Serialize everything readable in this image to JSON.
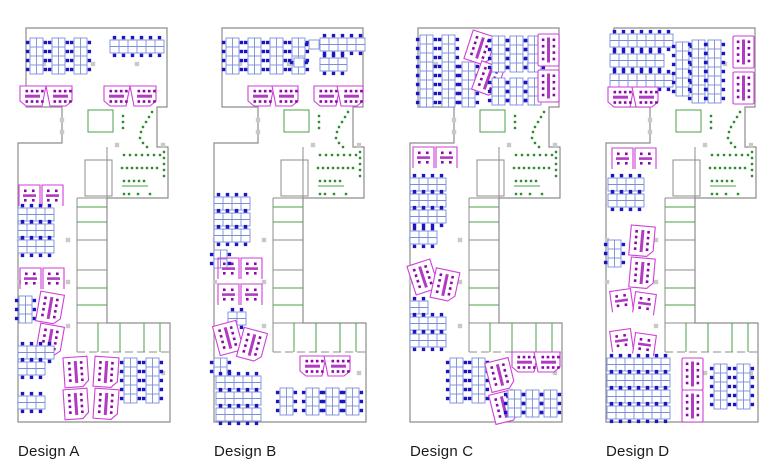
{
  "palette": {
    "wall": "#8d8d8d",
    "column": "#c9c9c9",
    "green": "#4aa04a",
    "greenDot": "#2d8c2d",
    "deskStroke": "#7b8fd9",
    "deskFill": "#ffffff",
    "chair": "#1c16c0",
    "pod": "#cf3fd8",
    "podDot": "#8d07a8",
    "podBar": "#b13cc2",
    "label": "#1a1a1a",
    "background": "#ffffff"
  },
  "architecture": {
    "outline": [
      [
        8,
        28
      ],
      [
        149,
        28
      ],
      [
        149,
        107
      ],
      [
        139,
        107
      ],
      [
        139,
        147
      ],
      [
        150,
        147
      ],
      [
        150,
        198
      ],
      [
        89,
        198
      ],
      [
        89,
        323
      ],
      [
        152,
        323
      ],
      [
        152,
        422
      ],
      [
        0,
        422
      ],
      [
        0,
        143
      ],
      [
        44,
        143
      ],
      [
        44,
        107
      ],
      [
        8,
        107
      ]
    ],
    "wall_lines": [
      [
        89,
        147,
        89,
        198
      ],
      [
        59,
        198,
        89,
        198
      ],
      [
        59,
        198,
        59,
        323
      ],
      [
        59,
        323,
        89,
        323
      ],
      [
        59,
        323,
        59,
        352
      ]
    ],
    "dashed_lines": [
      [
        59,
        352,
        152,
        352
      ]
    ],
    "wall_rects": [
      [
        67,
        160,
        27,
        36
      ],
      [
        59,
        240,
        30,
        30
      ]
    ],
    "green_rects": [
      [
        70,
        110,
        25,
        22
      ]
    ],
    "green_lines": [
      [
        59,
        207,
        89,
        207
      ],
      [
        59,
        222,
        89,
        222
      ],
      [
        59,
        288,
        89,
        288
      ],
      [
        59,
        305,
        89,
        305
      ],
      [
        80,
        323,
        80,
        352
      ],
      [
        102,
        323,
        102,
        352
      ],
      [
        126,
        323,
        126,
        352
      ],
      [
        142,
        323,
        142,
        352
      ],
      [
        104,
        186,
        130,
        186
      ]
    ],
    "columns": [
      [
        75,
        64
      ],
      [
        119,
        64
      ],
      [
        26,
        64
      ],
      [
        44,
        120
      ],
      [
        44,
        132
      ],
      [
        99,
        145
      ],
      [
        145,
        145
      ],
      [
        1,
        240
      ],
      [
        50,
        240
      ],
      [
        1,
        282
      ],
      [
        50,
        282
      ],
      [
        50,
        326
      ],
      [
        99,
        373
      ],
      [
        145,
        373
      ]
    ],
    "break_dots": [
      [
        134,
        112
      ],
      [
        131,
        117
      ],
      [
        128,
        122
      ],
      [
        125,
        127
      ],
      [
        123,
        132
      ],
      [
        122,
        138
      ],
      [
        125,
        143
      ],
      [
        129,
        147
      ],
      [
        105,
        116
      ],
      [
        105,
        122
      ],
      [
        105,
        128
      ],
      [
        146,
        152
      ],
      [
        146,
        158
      ],
      [
        146,
        164
      ],
      [
        146,
        170
      ],
      [
        146,
        176
      ],
      [
        106,
        155
      ],
      [
        112,
        155
      ],
      [
        118,
        155
      ],
      [
        124,
        155
      ],
      [
        130,
        155
      ],
      [
        136,
        155
      ],
      [
        142,
        155
      ],
      [
        104,
        168
      ],
      [
        109,
        168
      ],
      [
        114,
        168
      ],
      [
        119,
        168
      ],
      [
        124,
        168
      ],
      [
        129,
        168
      ],
      [
        134,
        168
      ],
      [
        139,
        168
      ],
      [
        106,
        181
      ],
      [
        111,
        181
      ],
      [
        116,
        181
      ],
      [
        121,
        181
      ],
      [
        126,
        181
      ],
      [
        106,
        194
      ],
      [
        111,
        194
      ],
      [
        120,
        194
      ],
      [
        132,
        194
      ]
    ]
  },
  "designs": [
    {
      "label": "Design A",
      "furniture": [
        {
          "t": "bv",
          "x": 12,
          "y": 38,
          "n": 4
        },
        {
          "t": "bv",
          "x": 34,
          "y": 38,
          "n": 4
        },
        {
          "t": "bv",
          "x": 56,
          "y": 38,
          "n": 4
        },
        {
          "t": "bh",
          "x": 92,
          "y": 40,
          "n": 6
        },
        {
          "t": "ph",
          "x": 2,
          "y": 86,
          "s": -1
        },
        {
          "t": "ph",
          "x": 30,
          "y": 86,
          "s": 1
        },
        {
          "t": "ph",
          "x": 86,
          "y": 86,
          "s": -1
        },
        {
          "t": "ph",
          "x": 114,
          "y": 86,
          "s": 1
        },
        {
          "t": "ps",
          "x": 1,
          "y": 185
        },
        {
          "t": "ps",
          "x": 24,
          "y": 185
        },
        {
          "t": "bh",
          "x": 0,
          "y": 208,
          "n": 4
        },
        {
          "t": "bh",
          "x": 0,
          "y": 224,
          "n": 4
        },
        {
          "t": "bh",
          "x": 0,
          "y": 240,
          "n": 4
        },
        {
          "t": "ps",
          "x": 2,
          "y": 268
        },
        {
          "t": "ps",
          "x": 25,
          "y": 268
        },
        {
          "t": "bv",
          "x": 1,
          "y": 296,
          "n": 3
        },
        {
          "t": "pv",
          "x": 20,
          "y": 293,
          "r": 10
        },
        {
          "t": "pv",
          "x": 20,
          "y": 325,
          "r": 10
        },
        {
          "t": "bh",
          "x": 0,
          "y": 346,
          "n": 4
        },
        {
          "t": "bh",
          "x": 0,
          "y": 362,
          "n": 3
        },
        {
          "t": "bh",
          "x": 0,
          "y": 396,
          "n": 3
        },
        {
          "t": "pv",
          "x": 46,
          "y": 357,
          "r": -4
        },
        {
          "t": "pv",
          "x": 76,
          "y": 357,
          "r": 4
        },
        {
          "t": "pv",
          "x": 46,
          "y": 389,
          "r": -4
        },
        {
          "t": "pv",
          "x": 76,
          "y": 389,
          "r": 4
        },
        {
          "t": "bv",
          "x": 106,
          "y": 358,
          "n": 5
        },
        {
          "t": "bv",
          "x": 128,
          "y": 358,
          "n": 5
        }
      ]
    },
    {
      "label": "Design B",
      "furniture": [
        {
          "t": "bv",
          "x": 12,
          "y": 38,
          "n": 4
        },
        {
          "t": "bv",
          "x": 34,
          "y": 38,
          "n": 4
        },
        {
          "t": "bv",
          "x": 56,
          "y": 38,
          "n": 4
        },
        {
          "t": "bv",
          "x": 78,
          "y": 38,
          "n": 4
        },
        {
          "t": "ds",
          "x": 95,
          "y": 40
        },
        {
          "t": "bh",
          "x": 106,
          "y": 38,
          "n": 5
        },
        {
          "t": "ds",
          "x": 80,
          "y": 58
        },
        {
          "t": "bh",
          "x": 106,
          "y": 58,
          "n": 3
        },
        {
          "t": "ph",
          "x": 34,
          "y": 86,
          "s": -1
        },
        {
          "t": "ph",
          "x": 60,
          "y": 86,
          "s": 1
        },
        {
          "t": "ph",
          "x": 100,
          "y": 86,
          "s": -1
        },
        {
          "t": "ph",
          "x": 125,
          "y": 86,
          "s": 1
        },
        {
          "t": "bh",
          "x": 0,
          "y": 197,
          "n": 4
        },
        {
          "t": "bh",
          "x": 0,
          "y": 213,
          "n": 4
        },
        {
          "t": "bh",
          "x": 0,
          "y": 229,
          "n": 4
        },
        {
          "t": "bv",
          "x": 0,
          "y": 250,
          "n": 2
        },
        {
          "t": "ps",
          "x": 4,
          "y": 258
        },
        {
          "t": "ps",
          "x": 27,
          "y": 258
        },
        {
          "t": "ps",
          "x": 4,
          "y": 284
        },
        {
          "t": "ps",
          "x": 27,
          "y": 284
        },
        {
          "t": "bh",
          "x": 14,
          "y": 312,
          "n": 2
        },
        {
          "t": "pv",
          "x": 2,
          "y": 323,
          "r": -15
        },
        {
          "t": "pv",
          "x": 26,
          "y": 330,
          "r": 15
        },
        {
          "t": "bv",
          "x": 0,
          "y": 358,
          "n": 2
        },
        {
          "t": "bh",
          "x": 2,
          "y": 376,
          "n": 5
        },
        {
          "t": "bh",
          "x": 2,
          "y": 392,
          "n": 5
        },
        {
          "t": "bh",
          "x": 2,
          "y": 408,
          "n": 5
        },
        {
          "t": "bv",
          "x": 66,
          "y": 388,
          "n": 3
        },
        {
          "t": "bv",
          "x": 92,
          "y": 388,
          "n": 3
        },
        {
          "t": "bv",
          "x": 112,
          "y": 388,
          "n": 3
        },
        {
          "t": "bv",
          "x": 132,
          "y": 388,
          "n": 3
        },
        {
          "t": "ph",
          "x": 86,
          "y": 356,
          "s": -1
        },
        {
          "t": "ph",
          "x": 112,
          "y": 356,
          "s": 1
        }
      ]
    },
    {
      "label": "Design C",
      "furniture": [
        {
          "t": "bv",
          "x": 10,
          "y": 35,
          "n": 8
        },
        {
          "t": "bv",
          "x": 32,
          "y": 35,
          "n": 8
        },
        {
          "t": "bv",
          "x": 52,
          "y": 62,
          "n": 5
        },
        {
          "t": "pv",
          "x": 58,
          "y": 33,
          "r": 18
        },
        {
          "t": "pv",
          "x": 66,
          "y": 64,
          "r": 20
        },
        {
          "t": "bv",
          "x": 82,
          "y": 36,
          "n": 4
        },
        {
          "t": "bv",
          "x": 100,
          "y": 36,
          "n": 4
        },
        {
          "t": "bv",
          "x": 118,
          "y": 36,
          "n": 4
        },
        {
          "t": "bv",
          "x": 82,
          "y": 78,
          "n": 3
        },
        {
          "t": "bv",
          "x": 100,
          "y": 78,
          "n": 3
        },
        {
          "t": "bv",
          "x": 118,
          "y": 78,
          "n": 3
        },
        {
          "t": "pb",
          "x": 128,
          "y": 34
        },
        {
          "t": "pb",
          "x": 128,
          "y": 70
        },
        {
          "t": "ps",
          "x": 3,
          "y": 147
        },
        {
          "t": "ps",
          "x": 26,
          "y": 147
        },
        {
          "t": "bh",
          "x": 0,
          "y": 178,
          "n": 4
        },
        {
          "t": "bh",
          "x": 0,
          "y": 194,
          "n": 4
        },
        {
          "t": "bh",
          "x": 0,
          "y": 210,
          "n": 4
        },
        {
          "t": "bh",
          "x": 0,
          "y": 231,
          "n": 3
        },
        {
          "t": "pv",
          "x": 1,
          "y": 262,
          "r": -18
        },
        {
          "t": "pv",
          "x": 23,
          "y": 270,
          "r": 12
        },
        {
          "t": "bh",
          "x": 0,
          "y": 301,
          "n": 2
        },
        {
          "t": "bh",
          "x": 0,
          "y": 317,
          "n": 4
        },
        {
          "t": "bh",
          "x": 0,
          "y": 334,
          "n": 4
        },
        {
          "t": "bv",
          "x": 40,
          "y": 358,
          "n": 5
        },
        {
          "t": "bv",
          "x": 62,
          "y": 358,
          "n": 5
        },
        {
          "t": "pv",
          "x": 78,
          "y": 360,
          "r": -14
        },
        {
          "t": "pv",
          "x": 82,
          "y": 392,
          "r": -14
        },
        {
          "t": "ph",
          "x": 102,
          "y": 352,
          "s": -1
        },
        {
          "t": "ph",
          "x": 126,
          "y": 352,
          "s": 1
        },
        {
          "t": "bv",
          "x": 98,
          "y": 390,
          "n": 3
        },
        {
          "t": "bv",
          "x": 116,
          "y": 390,
          "n": 3
        },
        {
          "t": "bv",
          "x": 134,
          "y": 390,
          "n": 3
        }
      ]
    },
    {
      "label": "Design D",
      "furniture": [
        {
          "t": "bh",
          "x": 4,
          "y": 34,
          "n": 7
        },
        {
          "t": "bh",
          "x": 4,
          "y": 54,
          "n": 6
        },
        {
          "t": "bh",
          "x": 4,
          "y": 74,
          "n": 7
        },
        {
          "t": "ph",
          "x": 2,
          "y": 87,
          "s": -1
        },
        {
          "t": "ph",
          "x": 28,
          "y": 87,
          "s": 1
        },
        {
          "t": "bv",
          "x": 70,
          "y": 42,
          "n": 6
        },
        {
          "t": "bv",
          "x": 86,
          "y": 40,
          "n": 7
        },
        {
          "t": "bv",
          "x": 102,
          "y": 40,
          "n": 7
        },
        {
          "t": "pb",
          "x": 127,
          "y": 36
        },
        {
          "t": "pb",
          "x": 127,
          "y": 72
        },
        {
          "t": "ps",
          "x": 6,
          "y": 148
        },
        {
          "t": "ps",
          "x": 29,
          "y": 148
        },
        {
          "t": "bh",
          "x": 2,
          "y": 178,
          "n": 4
        },
        {
          "t": "bh",
          "x": 2,
          "y": 194,
          "n": 4
        },
        {
          "t": "bv",
          "x": 2,
          "y": 240,
          "n": 3
        },
        {
          "t": "pv",
          "x": 24,
          "y": 226,
          "r": 5
        },
        {
          "t": "pv",
          "x": 24,
          "y": 258,
          "r": 5
        },
        {
          "t": "ps",
          "x": 5,
          "y": 290,
          "r": -8
        },
        {
          "t": "ps",
          "x": 28,
          "y": 293,
          "r": 8
        },
        {
          "t": "ps",
          "x": 5,
          "y": 330,
          "r": -8
        },
        {
          "t": "ps",
          "x": 28,
          "y": 334,
          "r": 8
        },
        {
          "t": "bh",
          "x": 1,
          "y": 358,
          "n": 7
        },
        {
          "t": "bh",
          "x": 1,
          "y": 374,
          "n": 7
        },
        {
          "t": "bh",
          "x": 1,
          "y": 390,
          "n": 7
        },
        {
          "t": "bh",
          "x": 1,
          "y": 406,
          "n": 7
        },
        {
          "t": "pb",
          "x": 76,
          "y": 358
        },
        {
          "t": "pb",
          "x": 76,
          "y": 390
        },
        {
          "t": "bv",
          "x": 108,
          "y": 364,
          "n": 5
        },
        {
          "t": "bv",
          "x": 131,
          "y": 364,
          "n": 5
        }
      ]
    }
  ]
}
